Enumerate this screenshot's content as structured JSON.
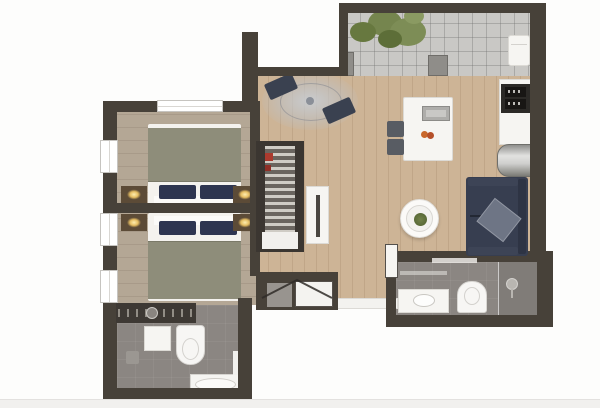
{
  "meta": {
    "title": "Apartment floor plan (3D top-down render)",
    "visible_text": "none"
  },
  "palette": {
    "background": "#fdfdfc",
    "footer_strip": "#f1f0ee",
    "wall": "#474139",
    "bedroom_floor": "#b4a795",
    "living_floor": "#cdb496",
    "balcony_floor": "#c9c8c5",
    "bathroom_floor": "#8b8682",
    "shower_floor": "#807c78",
    "bed_blanket": "#8e8d7a",
    "pillow_navy": "#2e3550",
    "sofa_navy": "#373e50",
    "sofa_throw": "#6e7585",
    "cushion_gray": "#3a4150",
    "nightstand_brown": "#5c4b37",
    "plant_green": "#75854e",
    "accent_red": "#ab3a2e",
    "metal_silver": "#c9c9c7",
    "mat_gray": "#98948f"
  },
  "rooms": [
    {
      "name": "bedroom",
      "features": [
        "double-bed-upper",
        "double-bed-lower",
        "headboard-divider-wall",
        "nightstands-with-lamps",
        "dresser-counter",
        "windows"
      ]
    },
    {
      "name": "bathroom-left",
      "features": [
        "toilet",
        "washbasin-cabinet",
        "bathtub",
        "floor-drain"
      ]
    },
    {
      "name": "living-dining-room",
      "features": [
        "round-rug-with-cushions",
        "dining-table",
        "chairs",
        "coffee-table",
        "sofa",
        "wardrobe",
        "sideboard"
      ]
    },
    {
      "name": "kitchen-strip",
      "features": [
        "oven-microwave-stack",
        "counter",
        "fridge"
      ]
    },
    {
      "name": "bathroom-right",
      "features": [
        "vanity-sink",
        "toilet",
        "shower"
      ]
    },
    {
      "name": "balcony",
      "features": [
        "tile-floor",
        "plant",
        "lounge-chair",
        "door-posts"
      ]
    },
    {
      "name": "entry-vestibule",
      "features": [
        "double-door-swing",
        "doormat",
        "door-leaf"
      ]
    }
  ]
}
